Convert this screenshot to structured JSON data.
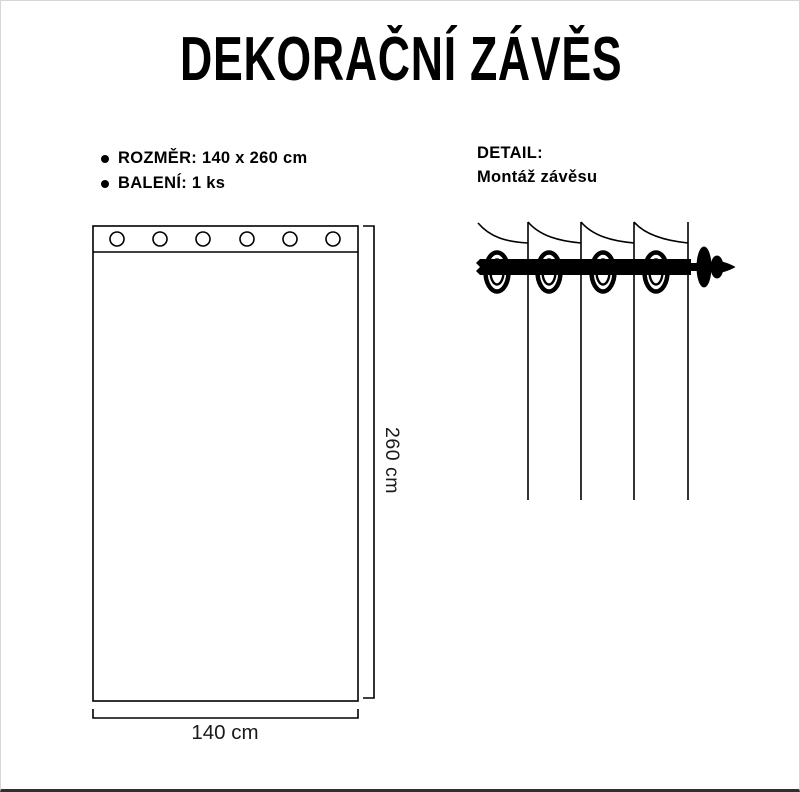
{
  "title": "DEKORAČNÍ ZÁVĚS",
  "specs": {
    "items": [
      "ROZMĚR: 140 x 260 cm",
      "BALENÍ: 1 ks"
    ]
  },
  "detail": {
    "heading": "DETAIL:",
    "subheading": "Montáž závěsu"
  },
  "diagram": {
    "width_label": "140 cm",
    "height_label": "260 cm",
    "grommet_count": 6
  },
  "colors": {
    "ink": "#000000",
    "background": "#ffffff",
    "dimension_text": "#1a1a1a"
  }
}
